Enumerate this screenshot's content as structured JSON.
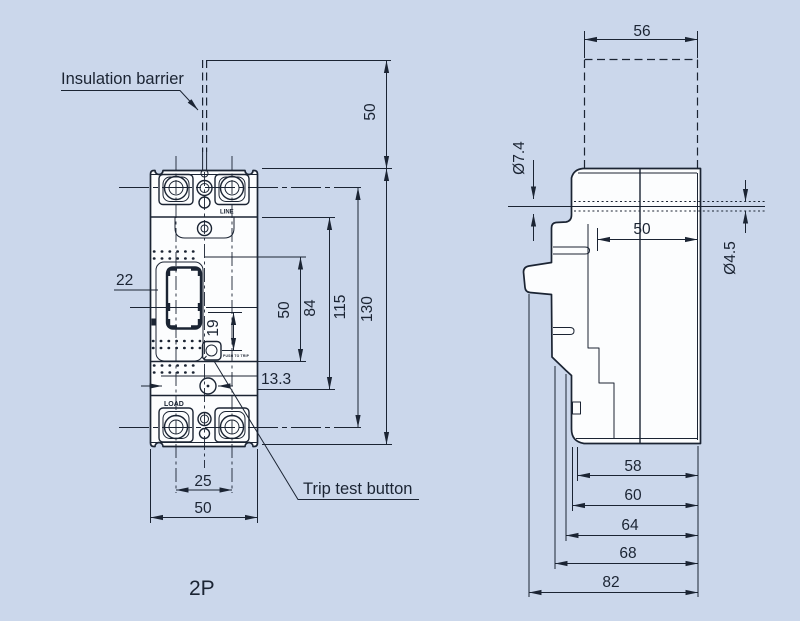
{
  "colors": {
    "background": "#cbd7eb",
    "ink": "#1b2433",
    "paper": "#fcfdfe"
  },
  "labels": {
    "insulation_barrier": "Insulation barrier",
    "trip_test_button": "Trip test button",
    "pole_count": "2P",
    "line_marking": "LINE",
    "load_marking": "LOAD",
    "trip_marking": "PUSH TO TRIP"
  },
  "front_view": {
    "dims": {
      "barrier_height": "50",
      "handle_width": "22",
      "handle_window": "19",
      "trip_offset": "13.3",
      "cover_height": "50",
      "inner_height": "84",
      "terminal_span": "115",
      "total_height": "130",
      "terminal_pitch": "25",
      "total_width": "50"
    }
  },
  "side_view": {
    "dims": {
      "barrier_width": "56",
      "counterbore_dia": "Ø7.4",
      "hole_dia": "Ø4.5",
      "hole_offset": "50",
      "depth_58": "58",
      "depth_60": "60",
      "depth_64": "64",
      "depth_68": "68",
      "depth_82": "82"
    }
  }
}
